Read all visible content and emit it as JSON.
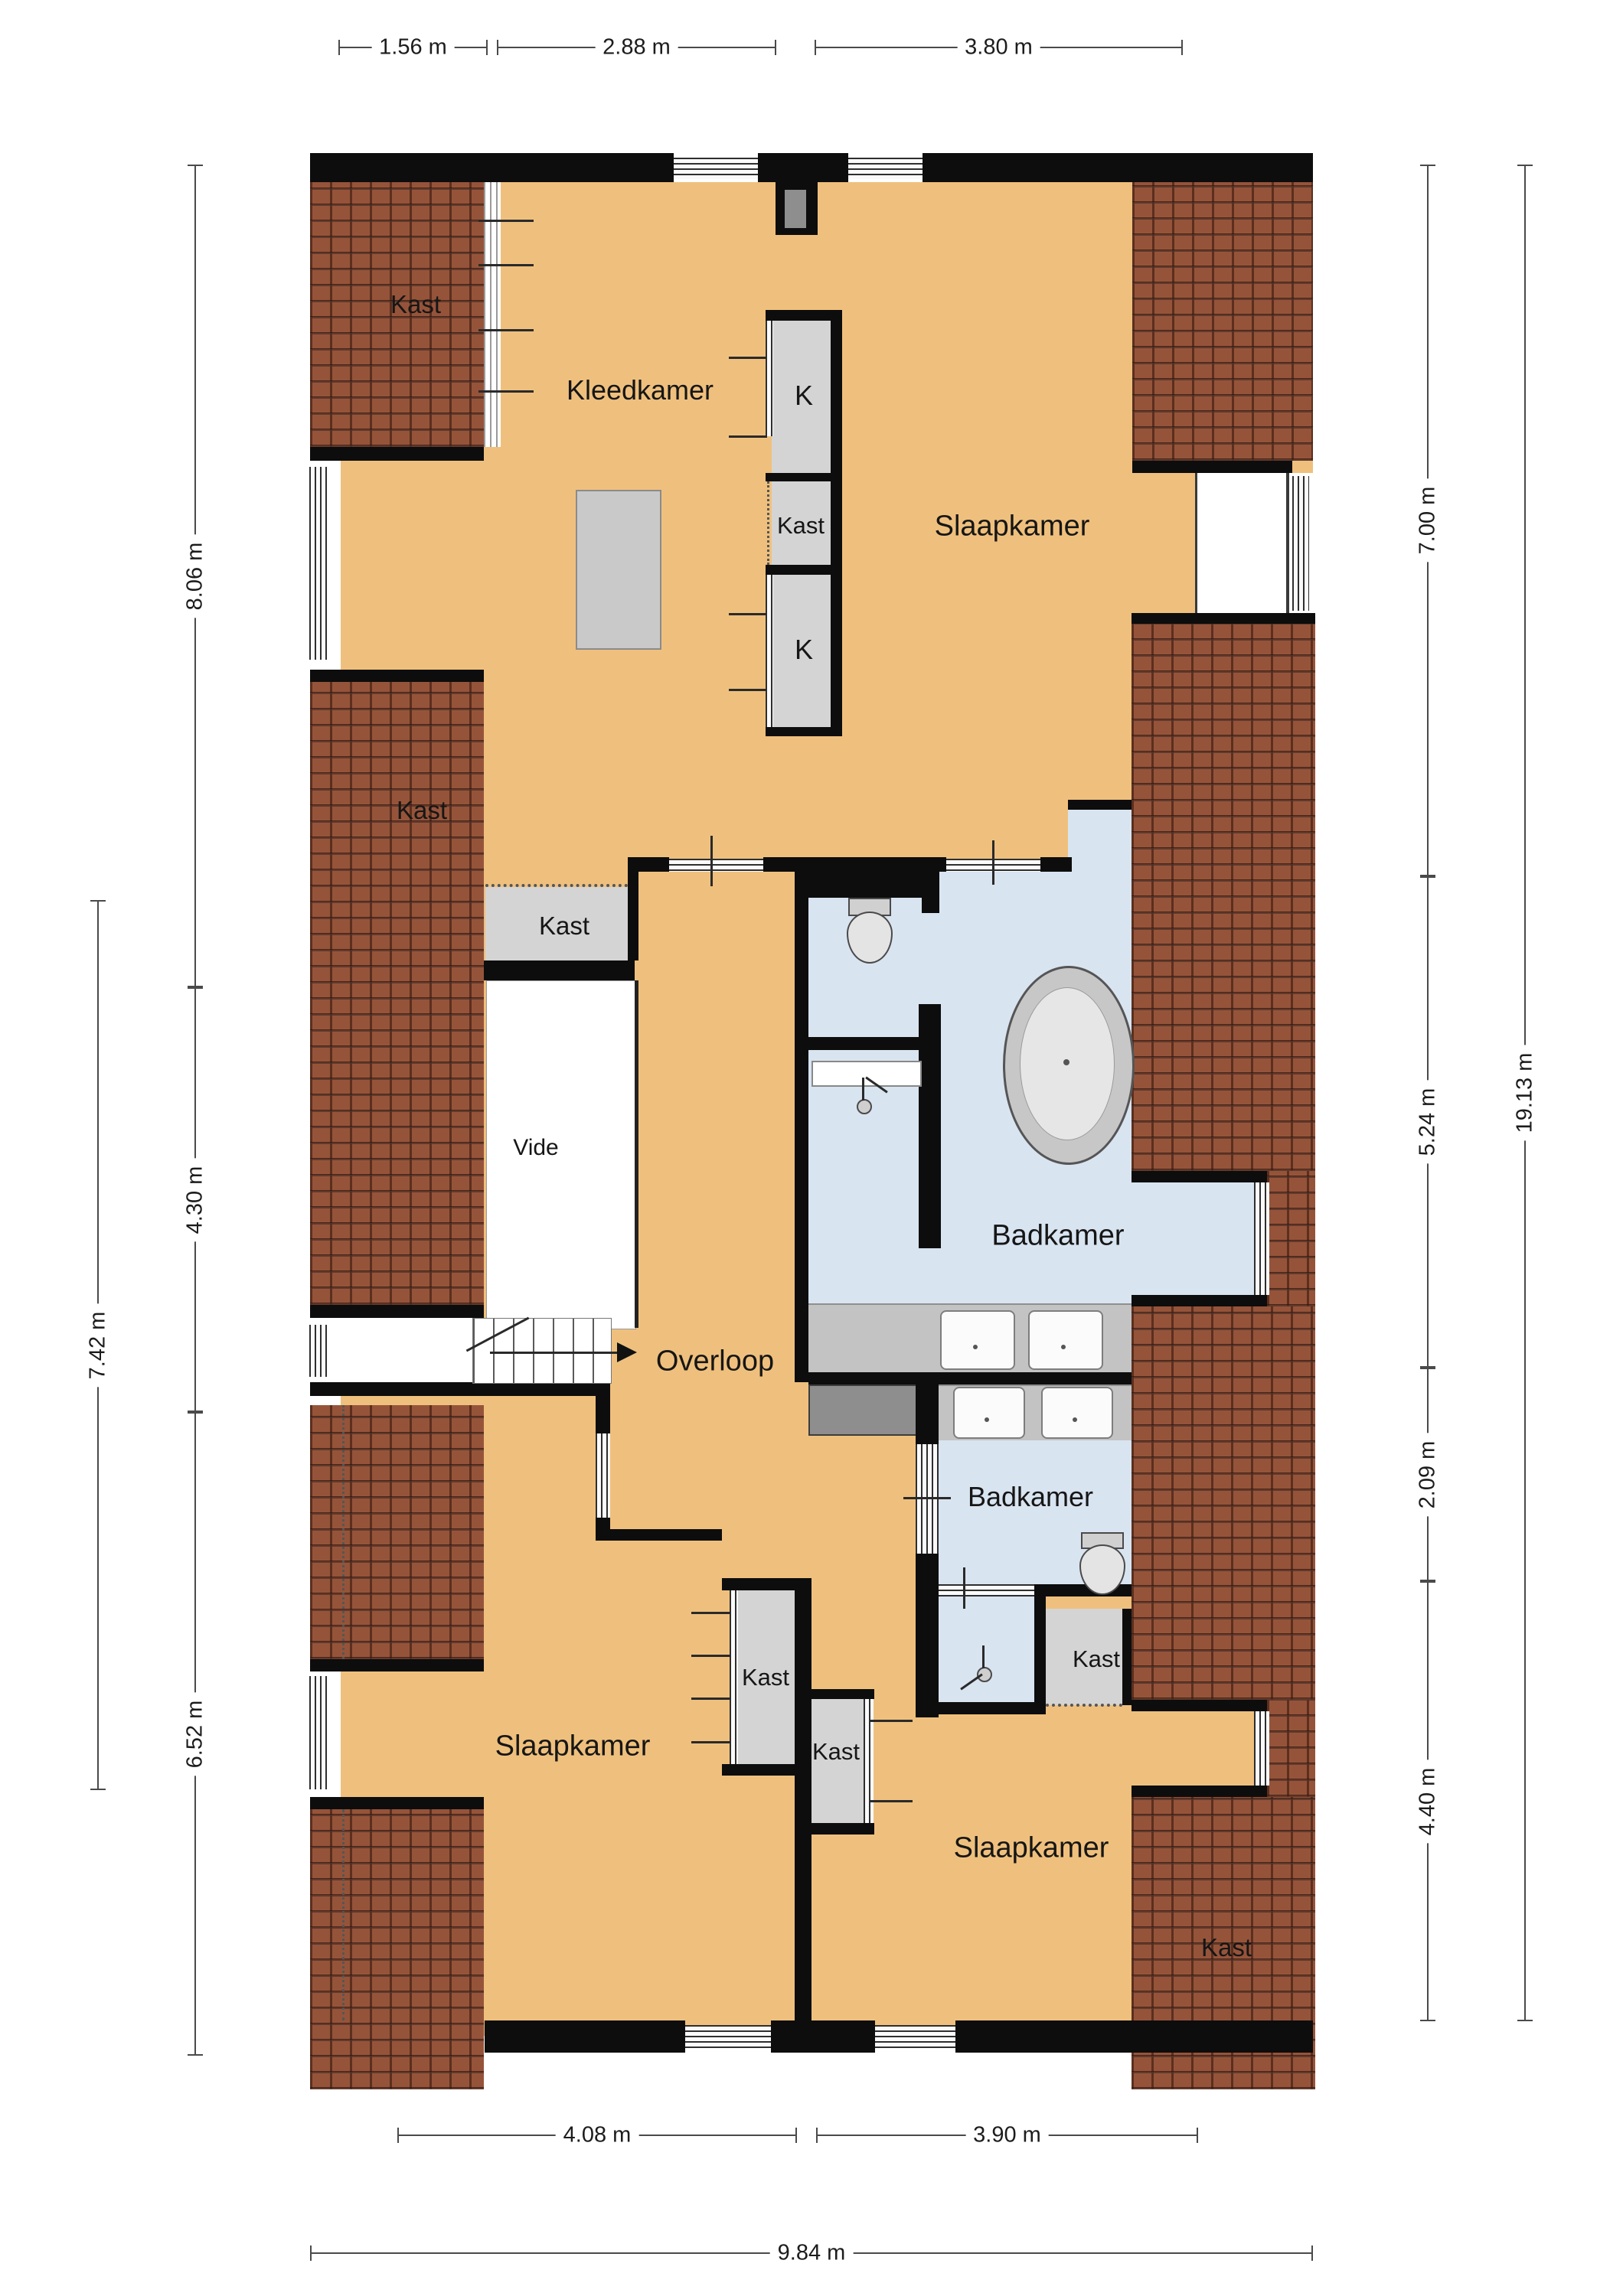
{
  "colors": {
    "floor_orange": "#efc07d",
    "bath_blue": "#d9e4f1",
    "closet_gray": "#d4d4d4",
    "counter_gray": "#c3c3c3",
    "roof_tile": "#95543a",
    "wall_black": "#0d0d0d"
  },
  "rooms": [
    {
      "id": "kast-roof-tl",
      "label": "Kast"
    },
    {
      "id": "kleedkamer",
      "label": "Kleedkamer"
    },
    {
      "id": "k-top",
      "label": "K"
    },
    {
      "id": "kast-mid-column",
      "label": "Kast"
    },
    {
      "id": "slaapkamer-top",
      "label": "Slaapkamer"
    },
    {
      "id": "k-bottom",
      "label": "K"
    },
    {
      "id": "kast-roof-left",
      "label": "Kast"
    },
    {
      "id": "kast-overloop",
      "label": "Kast"
    },
    {
      "id": "vide",
      "label": "Vide"
    },
    {
      "id": "overloop",
      "label": "Overloop"
    },
    {
      "id": "badkamer-main",
      "label": "Badkamer"
    },
    {
      "id": "badkamer-klein",
      "label": "Badkamer"
    },
    {
      "id": "kast-badkamer",
      "label": "Kast"
    },
    {
      "id": "kast-slaapkamer-links",
      "label": "Kast"
    },
    {
      "id": "slaapkamer-links",
      "label": "Slaapkamer"
    },
    {
      "id": "kast-midden-onder",
      "label": "Kast"
    },
    {
      "id": "slaapkamer-rechts",
      "label": "Slaapkamer"
    },
    {
      "id": "kast-roof-br",
      "label": "Kast"
    }
  ],
  "dimensions": {
    "top": [
      "1.56 m",
      "2.88 m",
      "3.80 m"
    ],
    "bottom_inner": [
      "4.08 m",
      "3.90 m"
    ],
    "bottom_outer": [
      "9.84 m"
    ],
    "left_inner": [
      "8.06 m",
      "4.30 m",
      "6.52 m"
    ],
    "left_outer": [
      "7.42 m"
    ],
    "right_inner": [
      "7.00 m",
      "5.24 m",
      "2.09 m",
      "4.40 m"
    ],
    "right_outer": [
      "19.13 m"
    ]
  }
}
